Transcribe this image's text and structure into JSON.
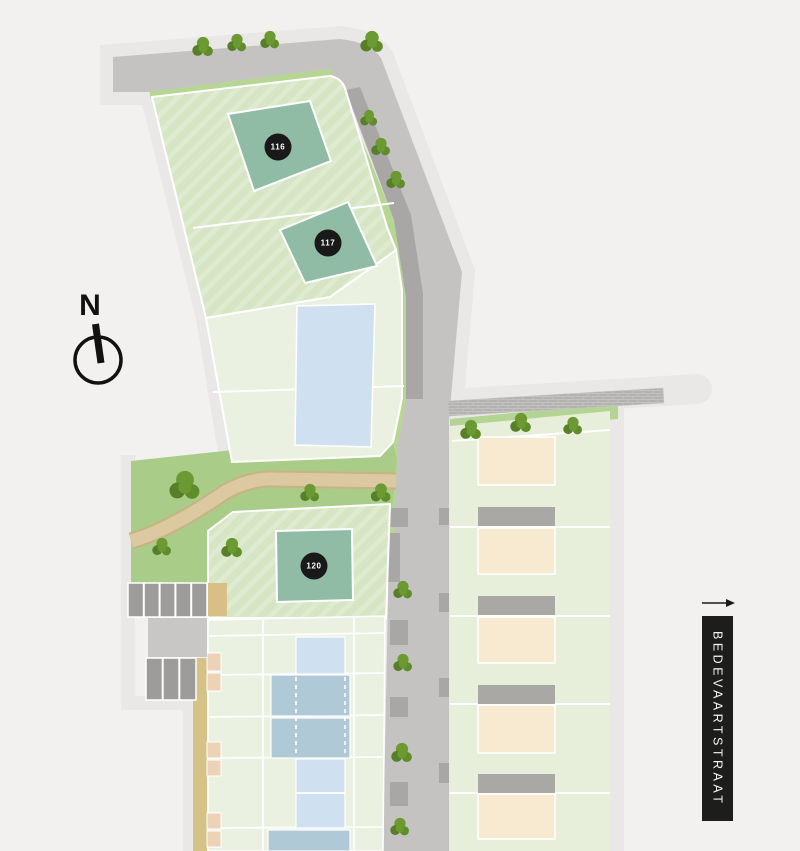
{
  "site_plan": {
    "compass": {
      "label": "N"
    },
    "street_banner": {
      "label": "BEDEVAARTSTRAAT"
    },
    "plot_markers": [
      {
        "number": "116"
      },
      {
        "number": "117"
      },
      {
        "number": "120"
      }
    ],
    "colors": {
      "background": "#f2f1f0",
      "halo": "#e9e8e6",
      "road": "#c4c3c2",
      "sidewalk": "#a8a7a6",
      "parcel_hatched_green": "#d6e5c3",
      "parcel_pale_green": "#eaf1e1",
      "right_block_green": "#e7efda",
      "green_pocket": "#a9cc89",
      "road_verge_green": "#b7d694",
      "building_teal": "#90bca6",
      "building_blue_light": "#cfe1f0",
      "building_blue_dark": "#b0c9d7",
      "building_beige": "#f8ead0",
      "garage_gray": "#aaa8a5",
      "parking_gray": "#9d9c9b",
      "path_tan": "#dcc9a1",
      "path_khaki": "#d5c287",
      "shed_peach": "#ecd3b8",
      "tree_green": "#6a9a31",
      "marker_black": "#191919",
      "banner_black": "#1d1d1b"
    }
  }
}
